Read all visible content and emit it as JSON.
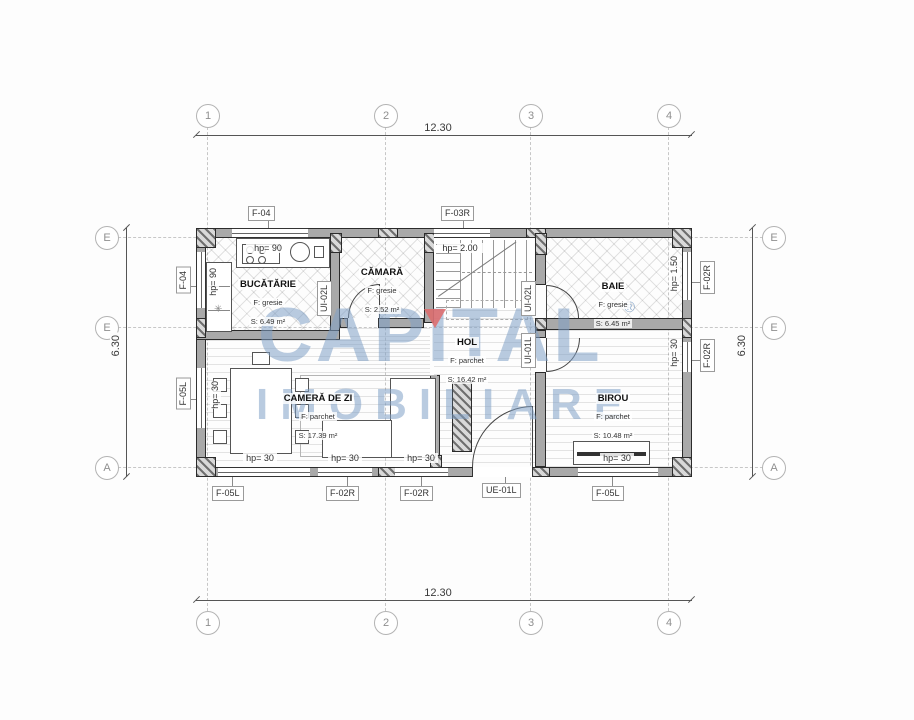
{
  "watermark": {
    "line1": "CAPITAL",
    "line2": "IMOBILIARE",
    "registered": "®"
  },
  "grid": {
    "cols": [
      "1",
      "2",
      "3",
      "4"
    ],
    "rows": [
      "E",
      "E",
      "A"
    ]
  },
  "dims": {
    "top": "12.30",
    "bottom": "12.30",
    "left": "6.30",
    "right": "6.30"
  },
  "rooms": {
    "kitchen": {
      "name": "BUCĂTĂRIE",
      "finish": "F: gresie",
      "area": "S: 6.49 m²"
    },
    "pantry": {
      "name": "CĂMARĂ",
      "finish": "F: gresie",
      "area": "S: 2.52 m²"
    },
    "bath": {
      "name": "BAIE",
      "finish": "F: gresie",
      "area": "S: 6.45 m²"
    },
    "hall": {
      "name": "HOL",
      "finish": "F: parchet",
      "area": "S: 16.42 m²"
    },
    "living": {
      "name": "CAMERĂ DE ZI",
      "finish": "F: parchet",
      "area": "S: 17.39 m²"
    },
    "office": {
      "name": "BIROU",
      "finish": "F: parchet",
      "area": "S: 10.48 m²"
    }
  },
  "tags": {
    "top_window_kitchen": "F-04",
    "top_window_stairs": "F-03R",
    "left_window_kitchen": "F-04",
    "left_window_living": "F-05L",
    "right_window_bath": "F-02R",
    "right_window_office": "F-02R",
    "bottom_window_1": "F-05L",
    "bottom_window_2": "F-02R",
    "bottom_window_3": "F-02R",
    "entry_door": "UE-01L",
    "bottom_window_4": "F-05L",
    "door_pantry": "UI-02L",
    "door_bath": "UI-02L",
    "door_office": "UI-01L"
  },
  "sills": {
    "top_kitchen": "hp= 90",
    "top_stairs": "hp= 2.00",
    "left_kitchen": "hp= 90",
    "left_living": "hp= 30",
    "right_bath": "hp= 1.50",
    "right_office": "hp= 30",
    "bottom_1": "hp= 30",
    "bottom_2": "hp= 30",
    "bottom_3": "hp= 30",
    "bottom_4": "hp= 30"
  },
  "symbols": {
    "boiler": "✳"
  }
}
